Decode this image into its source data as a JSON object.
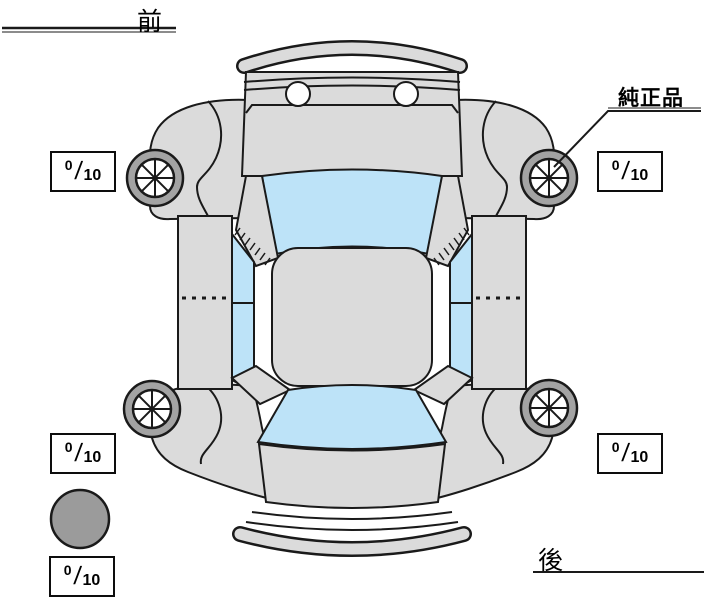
{
  "labels": {
    "front": "前",
    "rear": "後",
    "genuine_part": "純正品"
  },
  "tread": {
    "separator": "/",
    "front_left": {
      "value": "0",
      "max": "10"
    },
    "front_right": {
      "value": "0",
      "max": "10"
    },
    "rear_left": {
      "value": "0",
      "max": "10"
    },
    "rear_right": {
      "value": "0",
      "max": "10"
    },
    "spare": {
      "value": "0",
      "max": "10"
    }
  },
  "colors": {
    "body": "#dbdbdb",
    "glass": "#bde3f8",
    "wheel_ring": "#a3a3a3",
    "spare_tire": "#9b9b9b",
    "outline": "#1a1a1a",
    "background": "#ffffff"
  }
}
